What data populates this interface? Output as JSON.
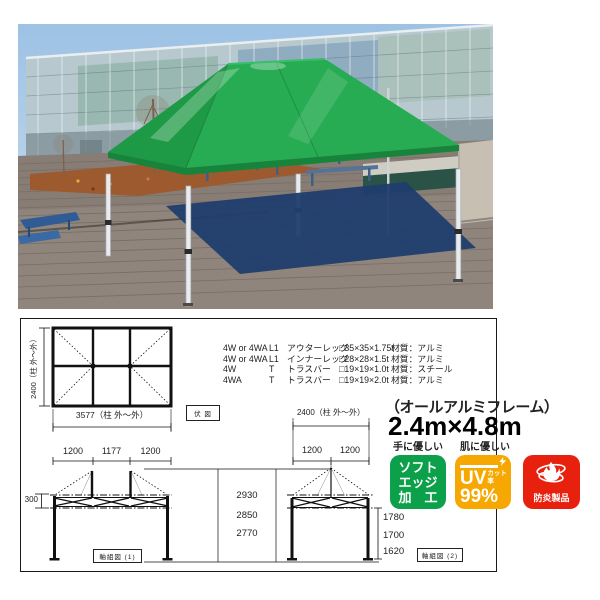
{
  "photo": {
    "canopy_color": "#28ac53",
    "shadow_color": "#203d6e"
  },
  "diagram": {
    "plan": {
      "side_label": "2400（柱 外～外）",
      "width_label": "3577（柱 外～外）",
      "segments": [
        "1200",
        "1177",
        "1200"
      ],
      "view_label": "伏 図"
    },
    "spec": {
      "rows": [
        {
          "model": "4W or 4WA",
          "code": "L1",
          "part": "アウターレッグ",
          "size": "□35×35×1.75t",
          "material": "材質：アルミ"
        },
        {
          "model": "4W or 4WA",
          "code": "L1",
          "part": "インナーレッグ",
          "size": "□28×28×1.5t",
          "material": "材質：アルミ"
        },
        {
          "model": "4W",
          "code": "T",
          "part": "トラスバー",
          "size": "□19×19×1.0t",
          "material": "材質：スチール"
        },
        {
          "model": "4WA",
          "code": "T",
          "part": "トラスバー",
          "size": "□19×19×2.0t",
          "material": "材質：アルミ"
        }
      ]
    },
    "frame_note": "（オールアルミフレーム）",
    "size_title": "2.4m×4.8m",
    "elevation1": {
      "truss_height": "300",
      "heights": [
        "2930",
        "2850",
        "2770"
      ],
      "label": "軸組図 (1)"
    },
    "elevation2": {
      "width_label": "2400（柱 外～外）",
      "segments": [
        "1200",
        "1200"
      ],
      "heights": [
        "1780",
        "1700",
        "1620"
      ],
      "label": "軸組図 (2)"
    },
    "badges": {
      "soft_edge": {
        "caption": "手に優しい",
        "line1": "ソフト",
        "line2": "エッジ",
        "line3": "加　工",
        "color": "#0ca04b"
      },
      "uv": {
        "caption": "肌に優しい",
        "word": "UV",
        "cut_label": "カット率",
        "percent": "99%",
        "color": "#f6a800"
      },
      "flame": {
        "label": "防炎製品",
        "color": "#e8210f"
      }
    }
  }
}
